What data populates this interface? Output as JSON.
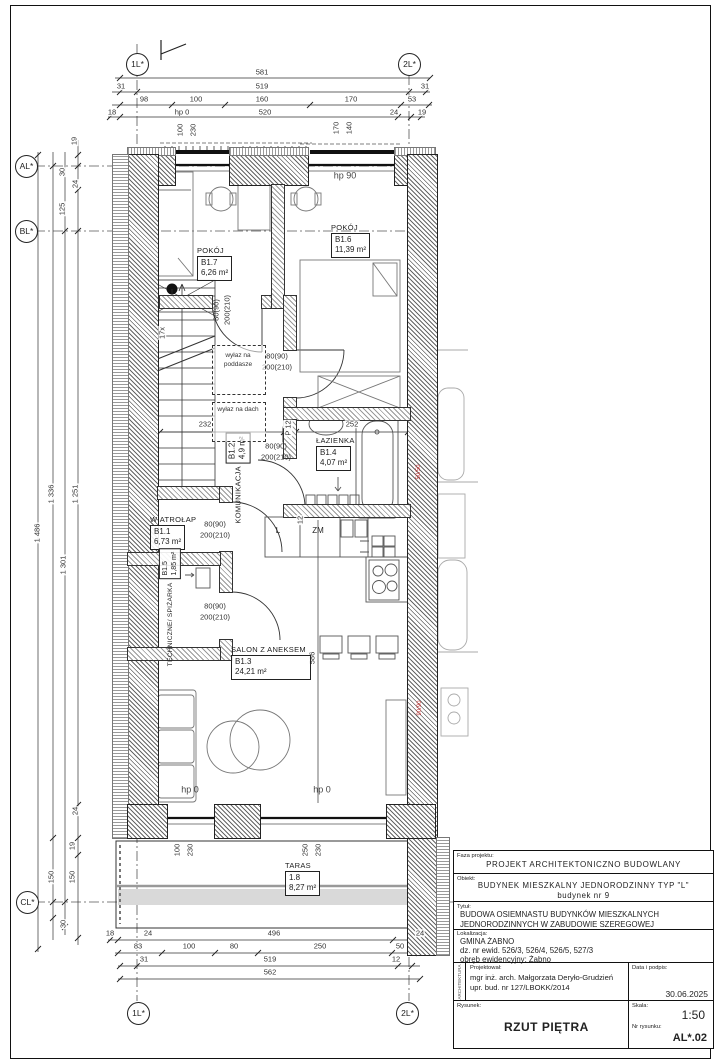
{
  "axes": {
    "top_left": "1L*",
    "top_right": "2L*",
    "bottom_left": "1L*",
    "bottom_right": "2L*",
    "left_a": "AL*",
    "left_b": "BL*",
    "left_c": "CL*"
  },
  "dims_top": {
    "r1": [
      "581"
    ],
    "r2": [
      "31",
      "519",
      "31"
    ],
    "r3": [
      "98",
      "100",
      "160",
      "170",
      "53"
    ],
    "r4": [
      "18",
      "520",
      "24",
      "19"
    ],
    "hp0": "hp 0",
    "win_a": [
      "100",
      "230"
    ],
    "win_b": [
      "170",
      "140"
    ],
    "hp90": "hp 90"
  },
  "dims_left": {
    "top": [
      "19",
      "30",
      "24",
      "125"
    ],
    "main": [
      "1 486",
      "1 336",
      "1 301",
      "1 251"
    ],
    "bottom": [
      "24",
      "19",
      "150",
      "150",
      "30"
    ]
  },
  "dims_bottom": {
    "r1": [
      "18",
      "24",
      "496",
      "24"
    ],
    "r2": [
      "83",
      "100",
      "80",
      "250",
      "50"
    ],
    "r3": [
      "31",
      "519",
      "12"
    ],
    "r4": [
      "562"
    ],
    "win_a": [
      "100",
      "230"
    ],
    "win_b": [
      "250",
      "230"
    ],
    "hp0_a": "hp 0",
    "hp0_b": "hp 0"
  },
  "dims_inner": {
    "b17": [
      "232",
      "12",
      "252"
    ],
    "salon_h": "586",
    "kitchen_t": "12",
    "p12": "P 12",
    "stairs": "17x"
  },
  "rooms": {
    "pokoj7": {
      "name": "POKÓJ",
      "id": "B1.7",
      "area": "6,26 m²"
    },
    "pokoj6": {
      "name": "POKÓJ",
      "id": "B1.6",
      "area": "11,39 m²"
    },
    "lazienka": {
      "name": "ŁAZIENKA",
      "id": "B1.4",
      "area": "4,07 m²"
    },
    "komunikacja": {
      "name": "KOMUNIKACJA",
      "id": "B1.2",
      "area": "4,9 m²"
    },
    "wiatrolap": {
      "name": "WIATROŁAP",
      "id": "B1.1",
      "area": "6,73 m²"
    },
    "techniczne": {
      "name": "TECHNICZNE/ SPIŻARKA",
      "id": "B1.5",
      "area": "1,85 m²"
    },
    "salon": {
      "name": "SALON Z ANEKSEM",
      "id": "B1.3",
      "area": "24,21 m²"
    },
    "taras": {
      "name": "TARAS",
      "id": "1.8",
      "area": "8,27 m²"
    }
  },
  "door_spec": {
    "w": "80(90)",
    "h": "200(210)"
  },
  "labels": {
    "wylaz_poddasze_1": "wyłaz na",
    "wylaz_poddasze_2": "poddasze",
    "wylaz_dach": "wyłaz na dach",
    "fridge": "L",
    "dishwasher": "ZM",
    "red_flue_1": "50/50",
    "red_flue_2": "90/90"
  },
  "title_block": {
    "faza_label": "Faza projektu:",
    "faza": "PROJEKT ARCHITEKTONICZNO BUDOWLANY",
    "obiekt_label": "Obiekt:",
    "obiekt_line1": "BUDYNEK MIESZKALNY JEDNORODZINNY TYP \"L\"",
    "obiekt_line2": "budynek nr 9",
    "tytul_label": "Tytuł:",
    "tytul_line1": "BUDOWA OSIEMNASTU BUDYNKÓW MIESZKALNYCH",
    "tytul_line2": "JEDNORODZINNYCH W ZABUDOWIE SZEREGOWEJ",
    "lokalizacja_label": "Lokalizacja:",
    "lokalizacja_line1": "GMINA ŻABNO",
    "lokalizacja_line2": "dz. nr ewid. 526/3, 526/4, 526/5, 527/3",
    "lokalizacja_line3": "obręb ewidencyjny:  Żabno",
    "branza_vertical": "ARCHITEKTURA",
    "projektowal_label": "Projektował:",
    "projektowal_line1": "mgr inż. arch. Małgorzata Deryło-Grudzień",
    "projektowal_line2": "upr. bud. nr 127/LBOKK/2014",
    "data_label": "Data i podpis:",
    "data": "30.06.2025",
    "rysunek_label": "Rysunek:",
    "rysunek": "RZUT PIĘTRA",
    "skala_label": "Skala:",
    "skala": "1:50",
    "nr_label": "Nr rysunku:",
    "nr": "AL*.02"
  }
}
